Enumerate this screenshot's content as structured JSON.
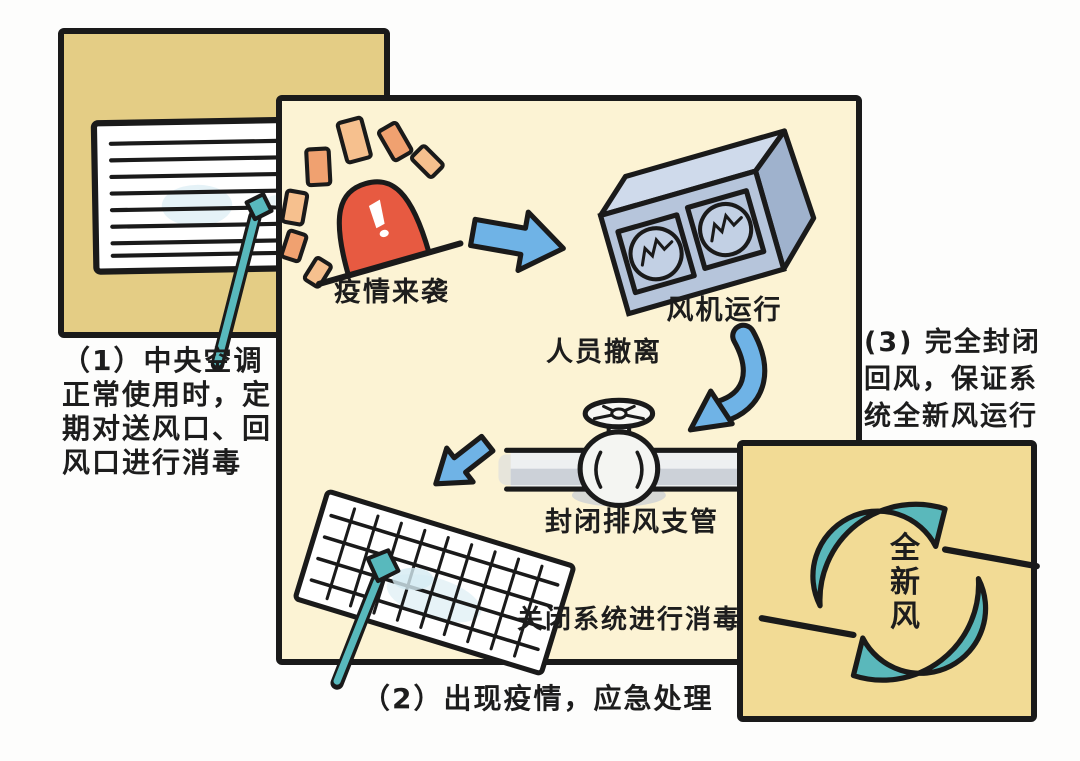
{
  "figure": {
    "title_meaning": "Central air-conditioning epidemic response steps",
    "panel_normal": {
      "bg": "#e4cd85",
      "caption_lines": [
        "（1）中央空调",
        "正常使用时，定",
        "期对送风口、回",
        "风口进行消毒"
      ]
    },
    "panel_emergency": {
      "bg": "#fcf3d4",
      "labels": {
        "alarm": "疫情来袭",
        "fan": "风机运行",
        "evacuate": "人员撤离",
        "valve": "封闭排风支管",
        "disinfect": "关闭系统进行消毒"
      },
      "caption": "（2）出现疫情，应急处理"
    },
    "panel_fresh_air": {
      "bg": "#f2db95",
      "caption_lines": [
        "(3) 完全封闭",
        "回风，保证系",
        "统全新风运行"
      ],
      "center_label_chars": [
        "全",
        "新",
        "风"
      ]
    },
    "colors": {
      "ink": "#1a1a1a",
      "arrow_blue": "#6fb3e6",
      "alarm_red": "#e75a41",
      "ray_orange": "#f0a170",
      "ray_orange_light": "#f6c08e",
      "teal": "#58b9bd",
      "fan_blue_front": "#b6c5db",
      "fan_blue_top": "#cfdaeb",
      "fan_blue_side": "#9fb2cd",
      "pipe_gray": "#c5cbd3",
      "mist_blue": "#cfe8f0"
    }
  }
}
